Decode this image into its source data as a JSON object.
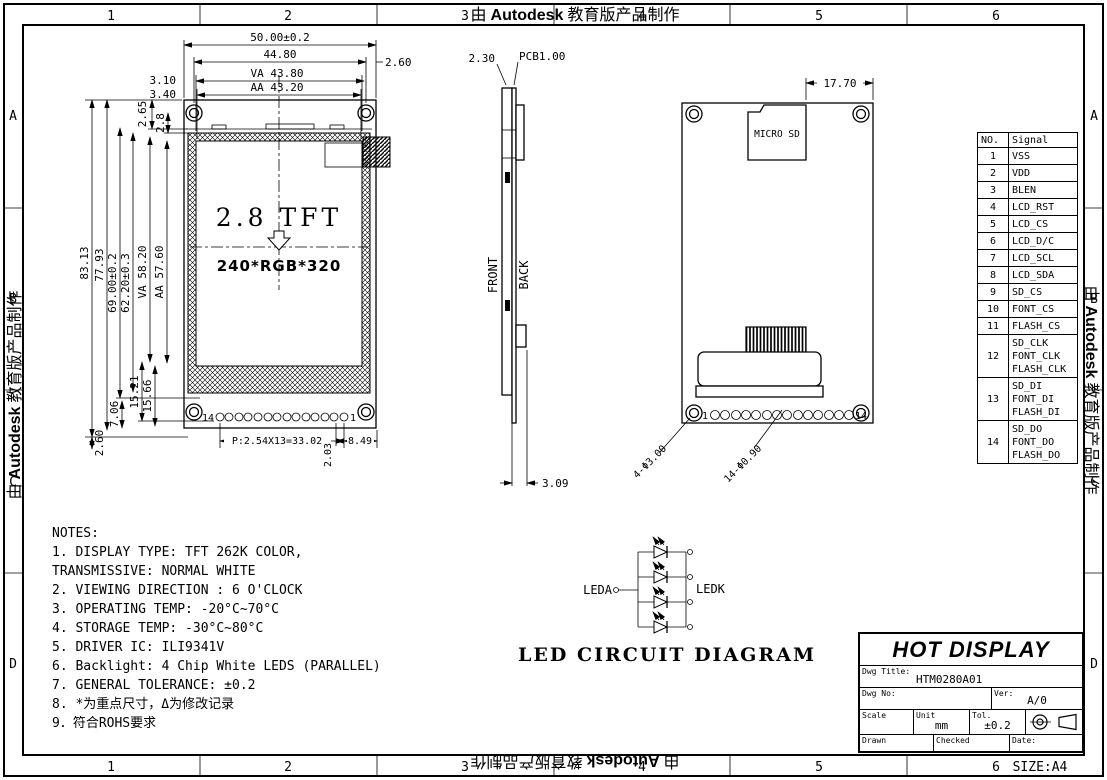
{
  "watermark": {
    "prefix": "由",
    "brand": "Autodesk",
    "suffix": "教育版产品制作"
  },
  "frame": {
    "columns": [
      "1",
      "2",
      "3",
      "4",
      "5",
      "6"
    ],
    "rows": [
      "A",
      "B",
      "C",
      "D"
    ],
    "size_label": "SIZE:A4"
  },
  "front_view": {
    "display_size": "2.8 TFT",
    "resolution": "240*RGB*320",
    "pin_last": "14",
    "pin_first": "1",
    "dims": {
      "overall_width": "50.00±0.2",
      "hole_span_width": "44.80",
      "va_width": "VA 43.80",
      "aa_width": "AA 43.20",
      "right_margin": "2.60",
      "va_offset": "3.10",
      "aa_offset": "3.40",
      "top_margin_1": "2.65",
      "top_margin_2": "2.8",
      "overall_height": "83.13",
      "height_2": "77.93",
      "height_3": "69.00±0.2",
      "height_4": "62.20±0.3",
      "va_height": "VA 58.20",
      "aa_height": "AA 57.60",
      "bottom_1": "15.21",
      "bottom_2": "15.66",
      "bottom_3": "7.06",
      "bottom_4": "2.60",
      "pin_pitch": "P:2.54X13=33.02",
      "pin_offset": "2.03",
      "pin_margin": "8.49"
    }
  },
  "side_view": {
    "glass_thickness": "2.30",
    "pcb_thickness": "PCB1.00",
    "front_label": "FRONT",
    "back_label": "BACK",
    "fpc_offset": "3.09"
  },
  "back_view": {
    "sd_offset": "17.70",
    "micro_sd_label": "MICRO SD",
    "pin_first": "1",
    "pin_last": "14",
    "holes_note": "4-Φ3.00",
    "pins_note": "14-Φ0.90"
  },
  "led_circuit": {
    "title": "LED CIRCUIT DIAGRAM",
    "anode": "LEDA",
    "cathode": "LEDK"
  },
  "notes": {
    "title": "NOTES:",
    "items": [
      "1. DISPLAY TYPE: TFT 262K COLOR,\n    TRANSMISSIVE: NORMAL WHITE",
      "2. VIEWING DIRECTION : 6 O'CLOCK",
      "3. OPERATING TEMP: -20°C~70°C",
      "4. STORAGE TEMP: -30°C~80°C",
      "5. DRIVER IC: ILI9341V",
      "6. Backlight: 4 Chip White LEDS (PARALLEL)",
      "7. GENERAL TOLERANCE: ±0.2",
      "8. *为重点尺寸，Δ为修改记录",
      "9．符合ROHS要求"
    ]
  },
  "signal_table": {
    "headers": [
      "NO.",
      "Signal"
    ],
    "rows": [
      {
        "no": "1",
        "signal": "VSS"
      },
      {
        "no": "2",
        "signal": "VDD"
      },
      {
        "no": "3",
        "signal": "BLEN"
      },
      {
        "no": "4",
        "signal": "LCD_RST"
      },
      {
        "no": "5",
        "signal": "LCD_CS"
      },
      {
        "no": "6",
        "signal": "LCD_D/C"
      },
      {
        "no": "7",
        "signal": "LCD_SCL"
      },
      {
        "no": "8",
        "signal": "LCD_SDA"
      },
      {
        "no": "9",
        "signal": "SD_CS"
      },
      {
        "no": "10",
        "signal": "FONT_CS"
      },
      {
        "no": "11",
        "signal": "FLASH_CS"
      },
      {
        "no": "12",
        "signal": "SD_CLK\nFONT_CLK\nFLASH_CLK"
      },
      {
        "no": "13",
        "signal": "SD_DI\nFONT_DI\nFLASH_DI"
      },
      {
        "no": "14",
        "signal": "SD_DO\nFONT_DO\nFLASH_DO"
      }
    ]
  },
  "title_block": {
    "company": "HOT DISPLAY",
    "dwg_title_label": "Dwg Title:",
    "dwg_title_value": "HTM0280A01",
    "dwg_no_label": "Dwg No:",
    "ver_label": "Ver:",
    "ver_value": "A/0",
    "scale_label": "Scale",
    "unit_label": "Unit",
    "unit_value": "mm",
    "tol_label": "Tol.",
    "tol_value": "±0.2",
    "drawn_label": "Drawn",
    "checked_label": "Checked",
    "date_label": "Date:"
  }
}
